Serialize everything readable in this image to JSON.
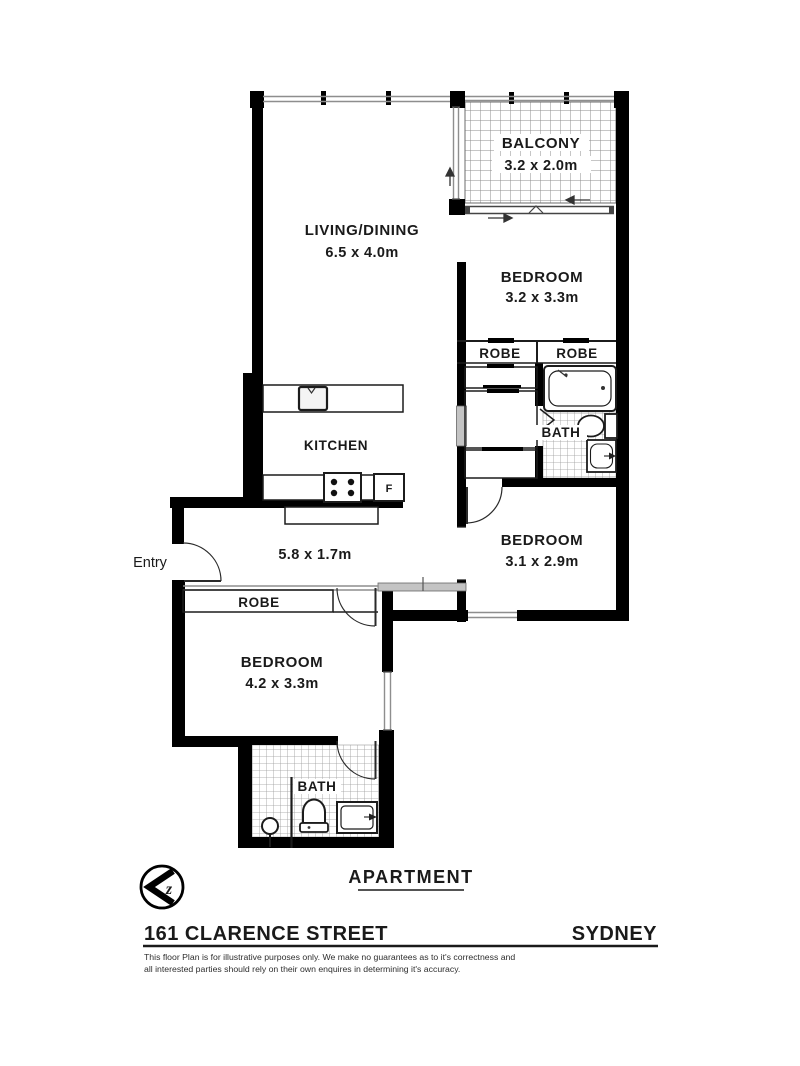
{
  "document": {
    "type_label": "APARTMENT",
    "address": "161 CLARENCE STREET",
    "city": "SYDNEY",
    "disclaimer": [
      "This floor Plan is for illustrative purposes only. We make no guarantees as to it's correctness and",
      "all interested parties should rely on their own enquires in determining it's accuracy."
    ],
    "compass_letter": "z"
  },
  "rooms": {
    "balcony": {
      "label": "BALCONY",
      "dims": "3.2 x 2.0m"
    },
    "living_dining": {
      "label": "LIVING/DINING",
      "dims": "6.5 x 4.0m"
    },
    "bedroom_top_right": {
      "label": "BEDROOM",
      "dims": "3.2 x 3.3m"
    },
    "robe_left": {
      "label": "ROBE"
    },
    "robe_right": {
      "label": "ROBE"
    },
    "bath_upper": {
      "label": "BATH"
    },
    "kitchen": {
      "label": "KITCHEN",
      "fridge_label": "F"
    },
    "hallway": {
      "dims": "5.8 x 1.7m"
    },
    "entry": {
      "label": "Entry"
    },
    "robe_hallway": {
      "label": "ROBE"
    },
    "bedroom_bottom_right": {
      "label": "BEDROOM",
      "dims": "3.1 x 2.9m"
    },
    "bedroom_bottom_left": {
      "label": "BEDROOM",
      "dims": "4.2 x 3.3m"
    },
    "bath_lower": {
      "label": "BATH"
    }
  },
  "colors": {
    "wall": "#000000",
    "text": "#1a1a1a",
    "glazing": "#8e8e8e",
    "grid": "#8d8d8d",
    "background": "#ffffff"
  }
}
